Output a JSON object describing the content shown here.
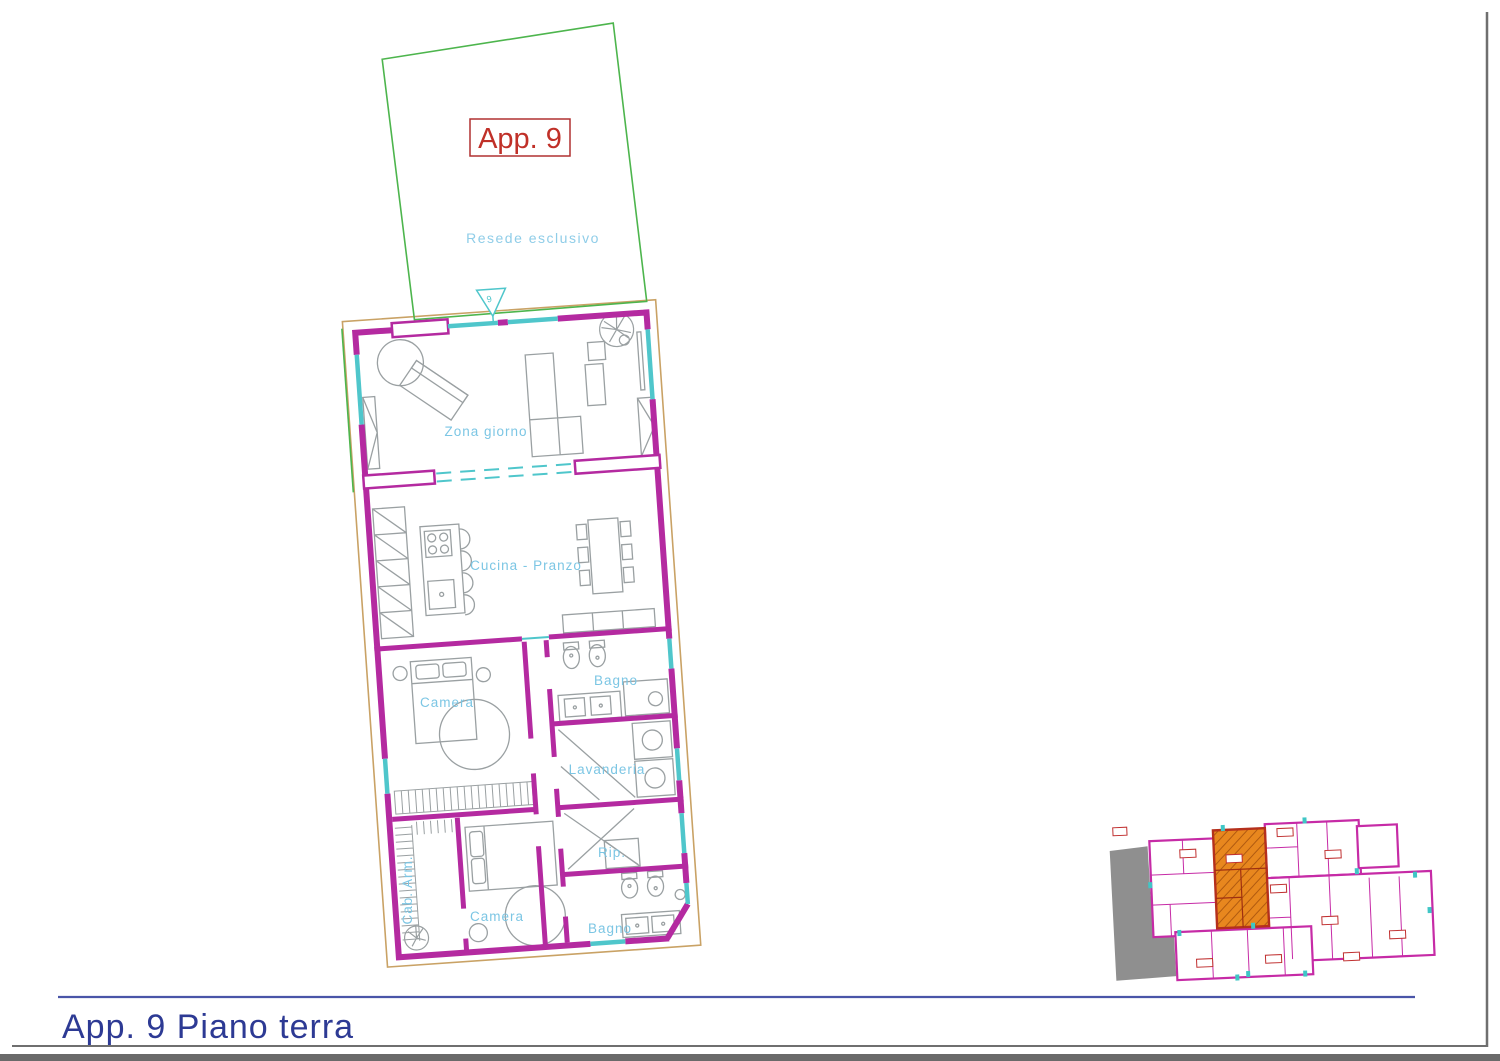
{
  "title": {
    "text": "App. 9 Piano terra"
  },
  "apartment": {
    "label": "App. 9",
    "entrance_number": "9"
  },
  "resede": {
    "label": "Resede esclusivo"
  },
  "rooms": {
    "zona_giorno": "Zona giorno",
    "cucina_pranzo": "Cucina - Pranzo",
    "camera_1": "Camera",
    "bagno_1": "Bagno",
    "lavanderia": "Lavanderia",
    "rip": "Rip.",
    "cab_arm": "Cab. Arm.",
    "camera_2": "Camera",
    "bagno_2": "Bagno"
  },
  "colors": {
    "wall_magenta": "#b42aa0",
    "window_cyan": "#4fc6cb",
    "room_label_blue": "#7cc6e4",
    "boundary_green": "#4db54d",
    "offset_tan": "#c9a265",
    "apartment_red": "#c03028",
    "title_blue": "#2d3a94",
    "rule_blue": "#4a55a8",
    "border_gray": "#6f6f6f",
    "furniture_gray": "#9aa0a2",
    "overview_highlight_orange": "#e8871e",
    "overview_mask_gray": "#8f8f8f"
  }
}
